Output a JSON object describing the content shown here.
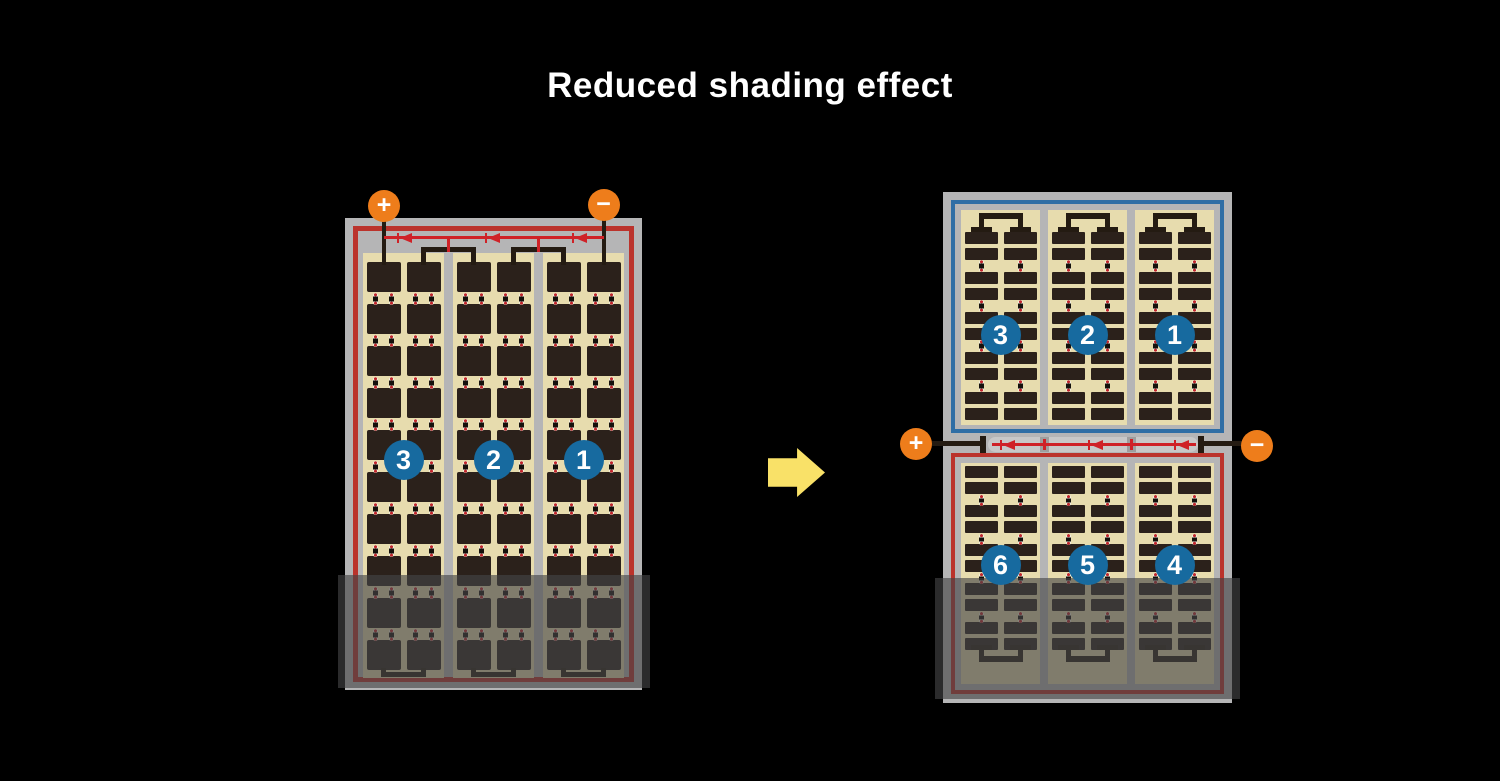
{
  "title": "Reduced shading effect",
  "left_module": {
    "terminals": {
      "positive": "+",
      "negative": "−"
    },
    "string_numbers": [
      "3",
      "2",
      "1"
    ]
  },
  "right_module": {
    "terminals": {
      "positive": "+",
      "negative": "−"
    },
    "top_string_numbers": [
      "3",
      "2",
      "1"
    ],
    "bottom_string_numbers": [
      "6",
      "5",
      "4"
    ]
  },
  "colors": {
    "background": "#000000",
    "frame_gray": "#b5b5b6",
    "cell_area_tan": "#e7dcae",
    "cell_dark": "#2b211b",
    "busbar_black": "#241b12",
    "module_border_red": "#bb332c",
    "module_border_blue": "#2f6ea5",
    "diode_wire_red": "#cf2127",
    "connector_dot_red": "#c0272d",
    "connector_pill_white": "#f4efdf",
    "terminal_orange": "#ee7d1b",
    "number_badge_blue": "#176a9f",
    "arrow_yellow": "#f9e168",
    "shading_overlay": "rgba(68,68,70,0.63)"
  }
}
